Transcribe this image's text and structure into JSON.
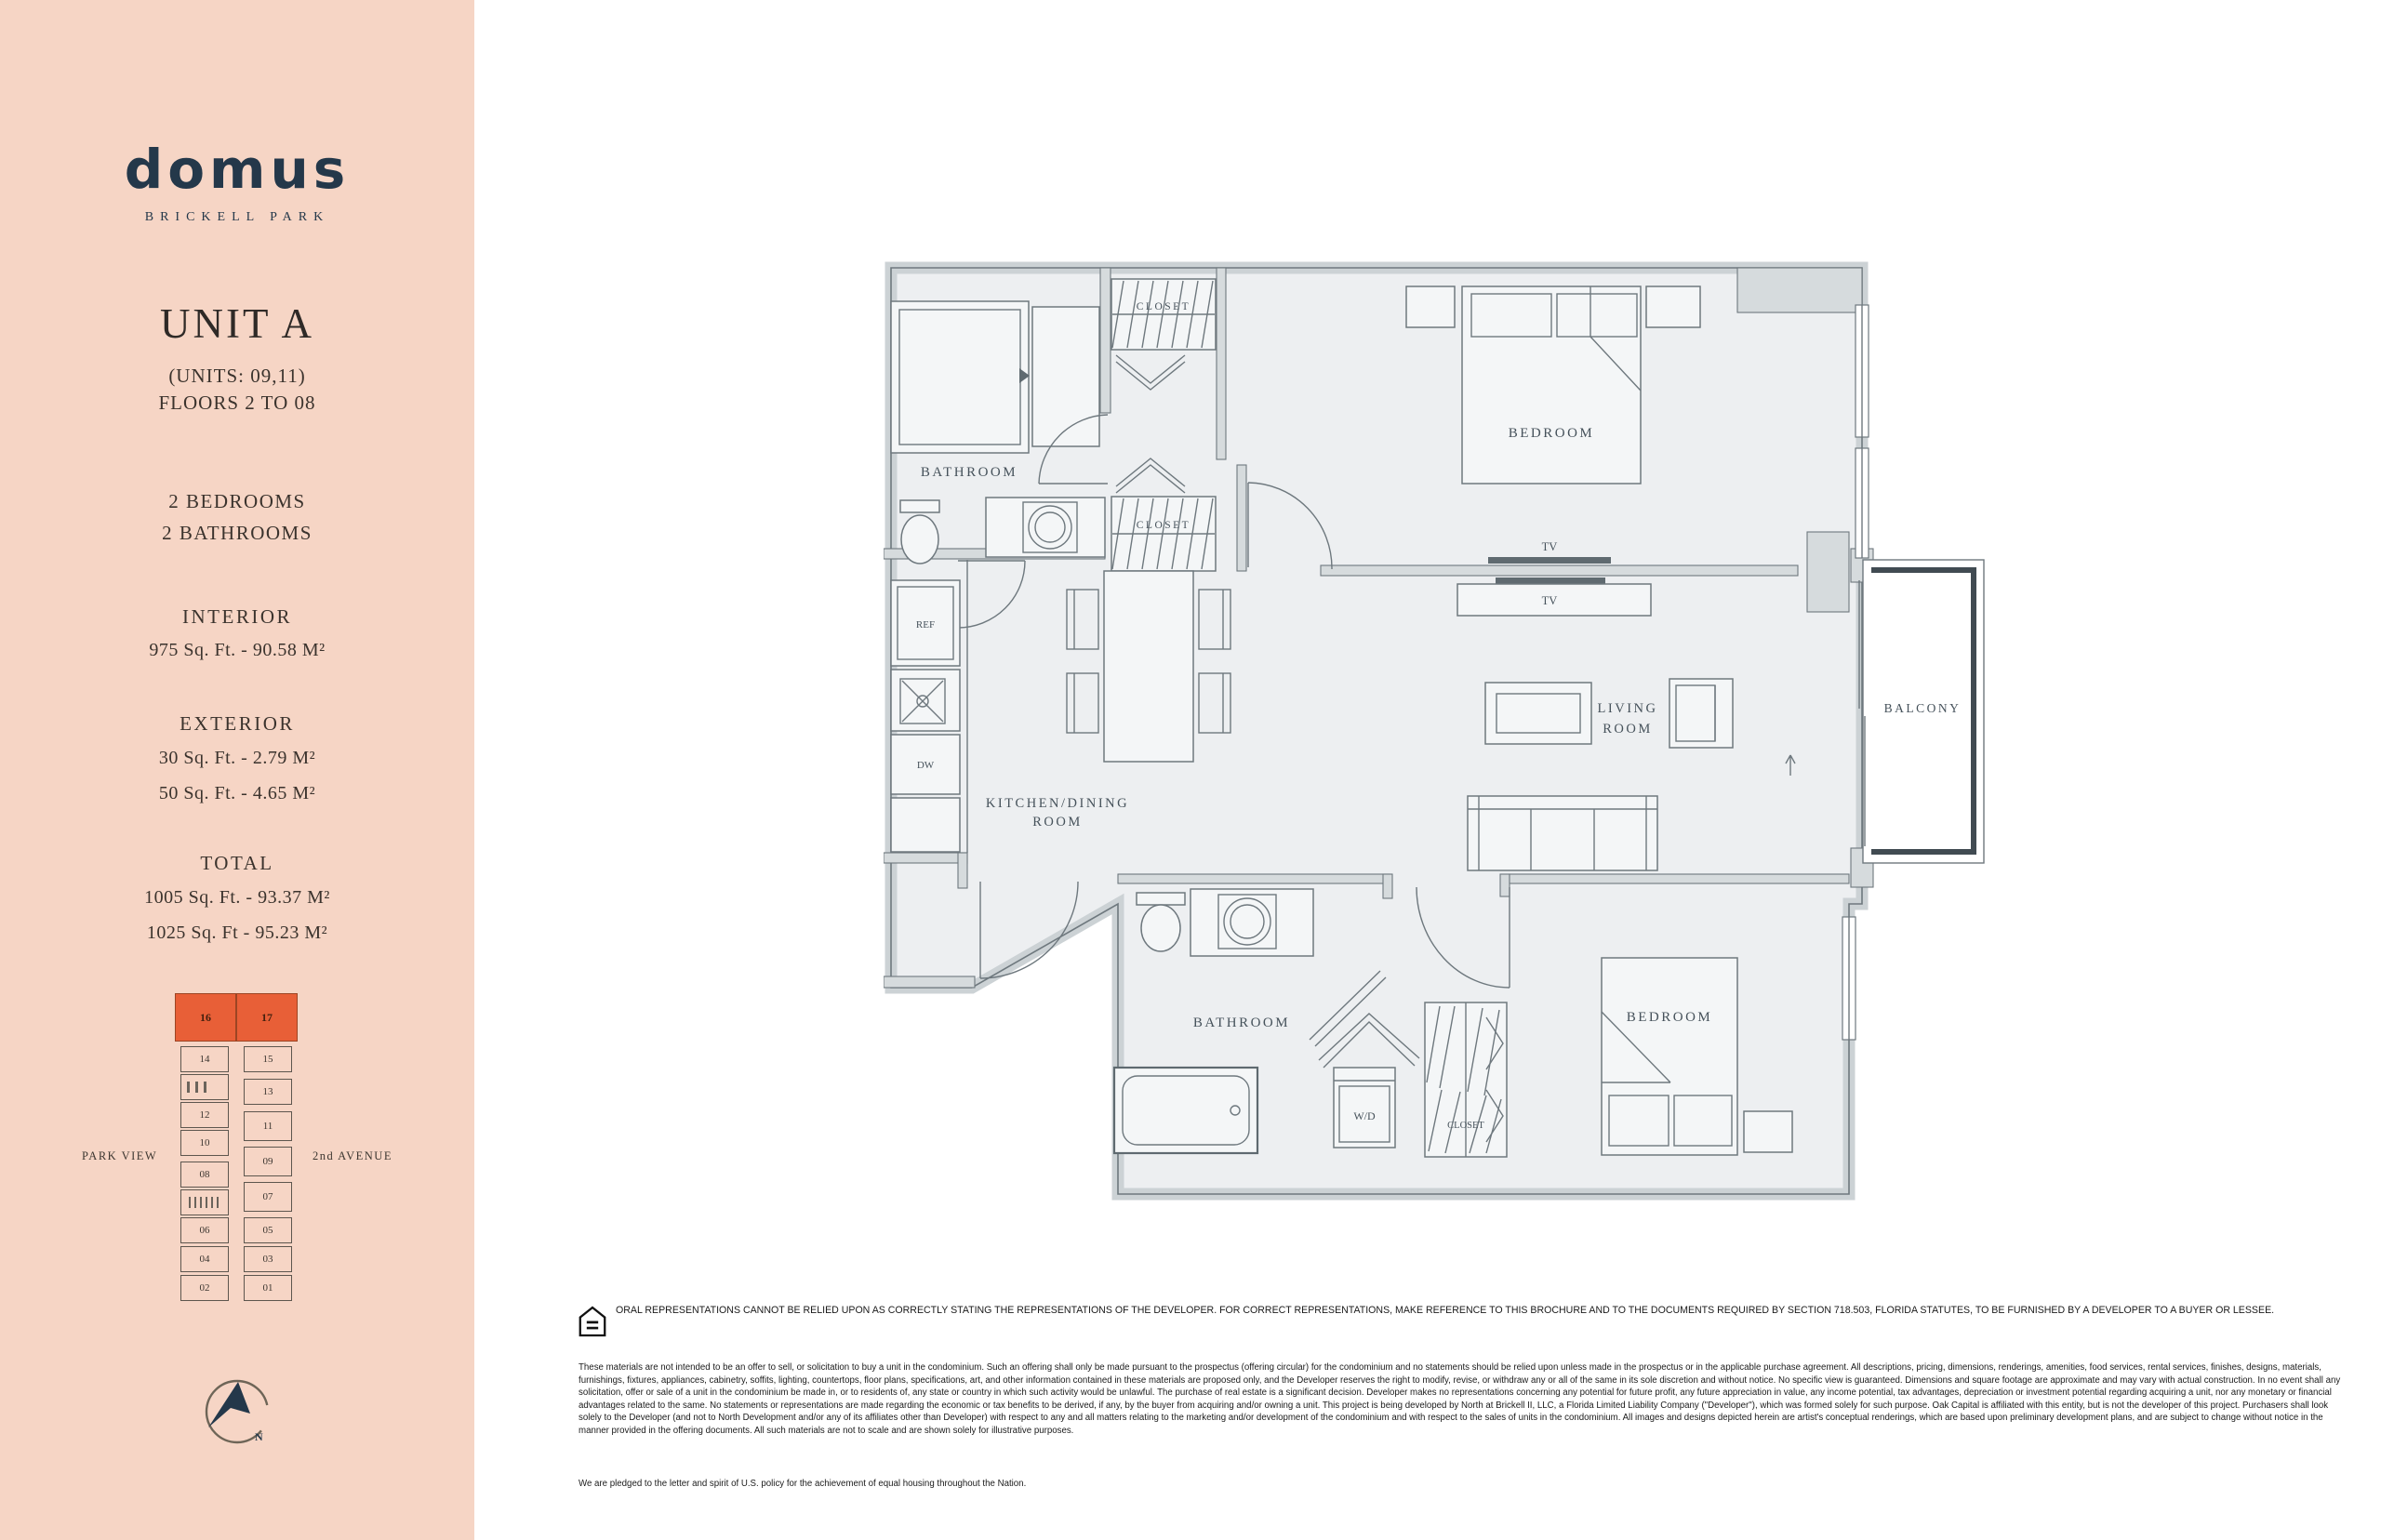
{
  "sidebar": {
    "background_color": "#f6d5c5",
    "accent_color": "#e85f37",
    "logo": {
      "name": "domus",
      "subtitle": "BRICKELL PARK"
    },
    "unit_title": "UNIT A",
    "unit_subtitle1": "(UNITS: 09,11)",
    "unit_subtitle2": "FLOORS 2 TO 08",
    "bedrooms": "2 BEDROOMS",
    "bathrooms": "2 BATHROOMS",
    "interior": {
      "heading": "INTERIOR",
      "line1": "975 Sq. Ft. - 90.58 M²"
    },
    "exterior": {
      "heading": "EXTERIOR",
      "line1": "30 Sq. Ft. - 2.79 M²",
      "line2": "50 Sq. Ft. - 4.65 M²"
    },
    "total": {
      "heading": "TOTAL",
      "line1": "1005 Sq. Ft. - 93.37 M²",
      "line2": "1025 Sq. Ft - 95.23 M²"
    },
    "keyplan": {
      "highlighted_units": [
        "16",
        "17"
      ],
      "left_column": [
        "14",
        "12",
        "10",
        "08",
        "06",
        "04",
        "02"
      ],
      "right_column": [
        "15",
        "13",
        "11",
        "09",
        "07",
        "05",
        "03",
        "01"
      ],
      "left_label": "PARK VIEW",
      "right_label": "2nd AVENUE"
    },
    "compass_label": "N"
  },
  "floorplan": {
    "labels": {
      "closet_top": "CLOSET",
      "closet_mid": "CLOSET",
      "bathroom_top": "BATHROOM",
      "bedroom_top": "BEDROOM",
      "tv_top": "TV",
      "tv_bottom": "TV",
      "ref": "REF",
      "dw": "DW",
      "kitchen_line1": "KITCHEN/DINING",
      "kitchen_line2": "ROOM",
      "living_line1": "LIVING",
      "living_line2": "ROOM",
      "balcony": "BALCONY",
      "bathroom_bottom": "BATHROOM",
      "wd": "W/D",
      "closet_bottom": "CLOSET",
      "bedroom_bottom": "BEDROOM"
    }
  },
  "disclaimer": {
    "headline": "ORAL REPRESENTATIONS CANNOT BE RELIED UPON AS CORRECTLY STATING THE REPRESENTATIONS OF THE DEVELOPER. FOR CORRECT REPRESENTATIONS, MAKE REFERENCE TO THIS BROCHURE AND TO THE DOCUMENTS REQUIRED BY SECTION 718.503, FLORIDA STATUTES, TO BE FURNISHED BY A DEVELOPER TO A BUYER OR LESSEE.",
    "body": "These materials are not intended to be an offer to sell, or solicitation to buy a unit in the condominium. Such an offering shall only be made pursuant to the prospectus (offering circular) for the condominium and no statements should be relied upon unless made in the prospectus or in the applicable purchase agreement. All descriptions, pricing, dimensions, renderings, amenities, food services, rental services, finishes, designs, materials, furnishings, fixtures, appliances, cabinetry, soffits, lighting, countertops, floor plans, specifications, art, and other information contained in these materials are proposed only, and the Developer reserves the right to modify, revise, or withdraw any or all of the same in its sole discretion and without notice. No specific view is guaranteed. Dimensions and square footage are approximate and may vary with actual construction. In no event shall any solicitation, offer or sale of a unit in the condominium be made in, or to residents of, any state or country in which such activity would be unlawful. The purchase of real estate is a significant decision. Developer makes no representations concerning any potential for future profit, any future appreciation in value, any income potential, tax advantages, depreciation or investment potential regarding acquiring a unit, nor any monetary or financial advantages related to the same. No statements or representations are made regarding the economic or tax benefits to be derived, if any, by the buyer from acquiring and/or owning a unit. This project is being developed by North at Brickell II, LLC, a Florida Limited Liability Company (\"Developer\"), which was formed solely for such purpose. Oak Capital is affiliated with this entity, but is not the developer of this project. Purchasers shall look solely to the Developer (and not to North Development and/or any of its affiliates other than Developer) with respect to any and all matters relating to the marketing and/or development of the condominium and with respect to the sales of units in the condominium. All images and designs depicted herein are artist's conceptual renderings, which are based upon preliminary development plans, and are subject to change without notice in the manner provided in the offering documents. All such materials are not to scale and are shown solely for illustrative purposes.",
    "equal_housing": "We are pledged to the letter and spirit of U.S. policy for the achievement of equal housing throughout the Nation."
  }
}
